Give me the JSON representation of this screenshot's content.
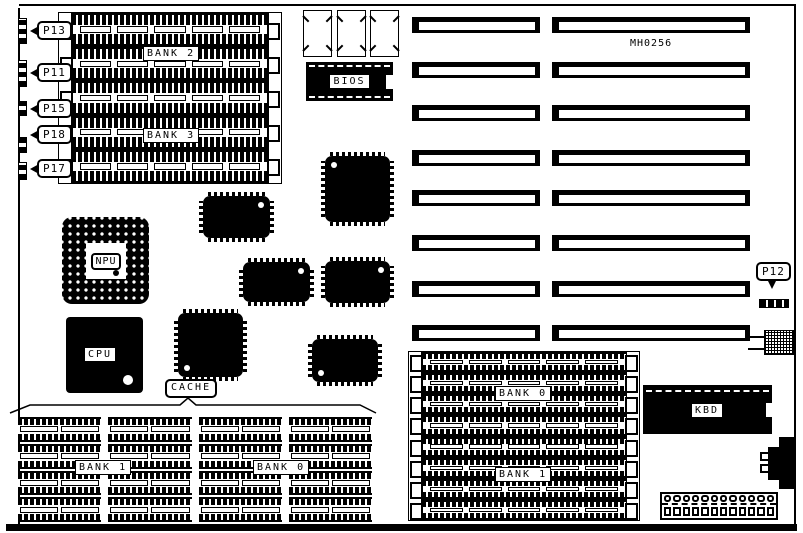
{
  "diagram": {
    "type": "motherboard-layout",
    "part_number": "MH0256"
  },
  "callouts": {
    "p13": "P13",
    "p11": "P11",
    "p15": "P15",
    "p18": "P18",
    "p17": "P17",
    "p12": "P12"
  },
  "chips": {
    "bios": "BIOS",
    "npu": "NPU",
    "cpu": "CPU",
    "cache": "CACHE",
    "kbd": "KBD"
  },
  "banks": {
    "top_left": [
      "BANK 2",
      "BANK 3"
    ],
    "bottom_left": [
      "BANK 1",
      "BANK 0"
    ],
    "bottom_right": [
      "BANK 0",
      "BANK 1"
    ]
  },
  "counts": {
    "top_left_simm_sockets": 5,
    "bottom_right_simm_sockets": 8,
    "cache_chip_rows": 4,
    "cache_chip_cols": 4,
    "expansion_slot_rows": 8,
    "expansion_slot_columns": 2,
    "power_connector_pins": 12,
    "wrects_per_simm": 5
  },
  "colors": {
    "ink": "#000000",
    "paper": "#ffffff"
  }
}
